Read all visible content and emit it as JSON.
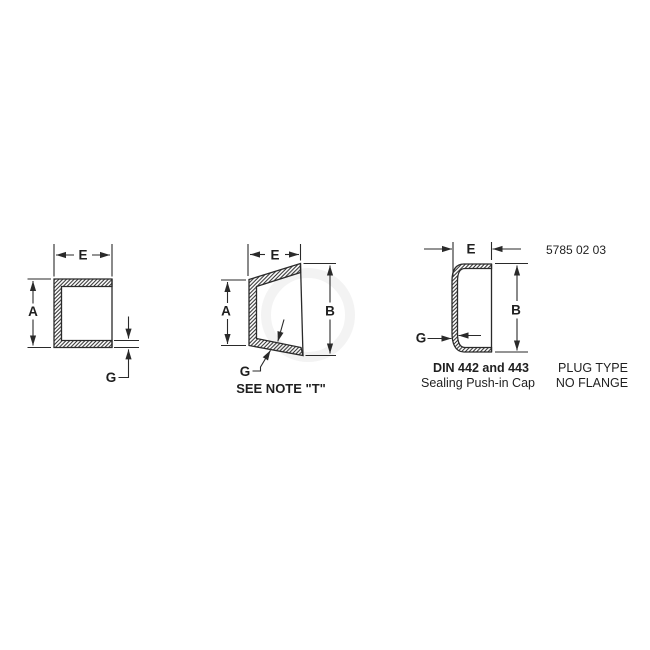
{
  "drawing": {
    "part_number": "5785 02 03",
    "colors": {
      "line": "#2a2a2a",
      "text": "#1f1f1f",
      "background": "#ffffff"
    },
    "square_cap_view": {
      "dim_e": "E",
      "dim_a": "A",
      "dim_g": "G"
    },
    "tapered_cap_view": {
      "dim_e": "E",
      "dim_a": "A",
      "dim_b": "B",
      "dim_g": "G",
      "note": "SEE NOTE \"T\""
    },
    "plug_cap_view": {
      "dim_e": "E",
      "dim_b": "B",
      "dim_g": "G",
      "standard": "DIN 442 and 443",
      "title": "Sealing Push-in Cap",
      "type_line1": "PLUG TYPE",
      "type_line2": "NO FLANGE"
    }
  }
}
